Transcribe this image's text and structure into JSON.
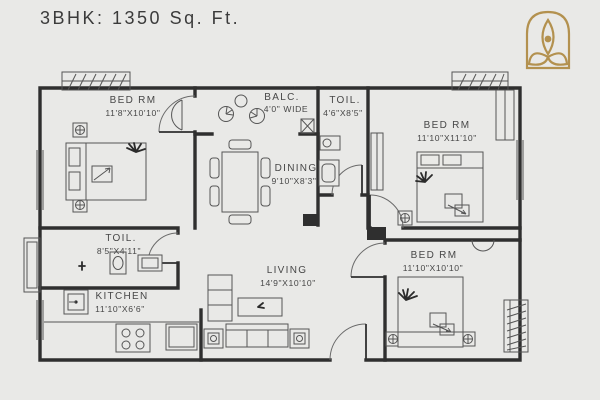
{
  "header": {
    "title": "3BHK: 1350 Sq. Ft."
  },
  "logo": {
    "name": "lotus-emblem",
    "color": "#b3914f"
  },
  "plan": {
    "background": "#e9e9e7",
    "wall_color": "#2f2f2f",
    "line_color": "#555555",
    "text_color": "#474747",
    "rooms": [
      {
        "id": "bedroom-1",
        "name": "BED RM",
        "dims": "11'8\"X10'10\""
      },
      {
        "id": "balcony",
        "name": "BALC.",
        "dims": "4'0\" WIDE"
      },
      {
        "id": "toilet-1",
        "name": "TOIL.",
        "dims": "4'6\"X8'5\""
      },
      {
        "id": "bedroom-2",
        "name": "BED RM",
        "dims": "11'10\"X11'10\""
      },
      {
        "id": "dining",
        "name": "DINING",
        "dims": "9'10\"X8'3\""
      },
      {
        "id": "toilet-2",
        "name": "TOIL.",
        "dims": "8'5\"X4'11\""
      },
      {
        "id": "kitchen",
        "name": "KITCHEN",
        "dims": "11'10\"X6'6\""
      },
      {
        "id": "living",
        "name": "LIVING",
        "dims": "14'9\"X10'10\""
      },
      {
        "id": "bedroom-3",
        "name": "BED RM",
        "dims": "11'10\"X10'10\""
      }
    ]
  }
}
